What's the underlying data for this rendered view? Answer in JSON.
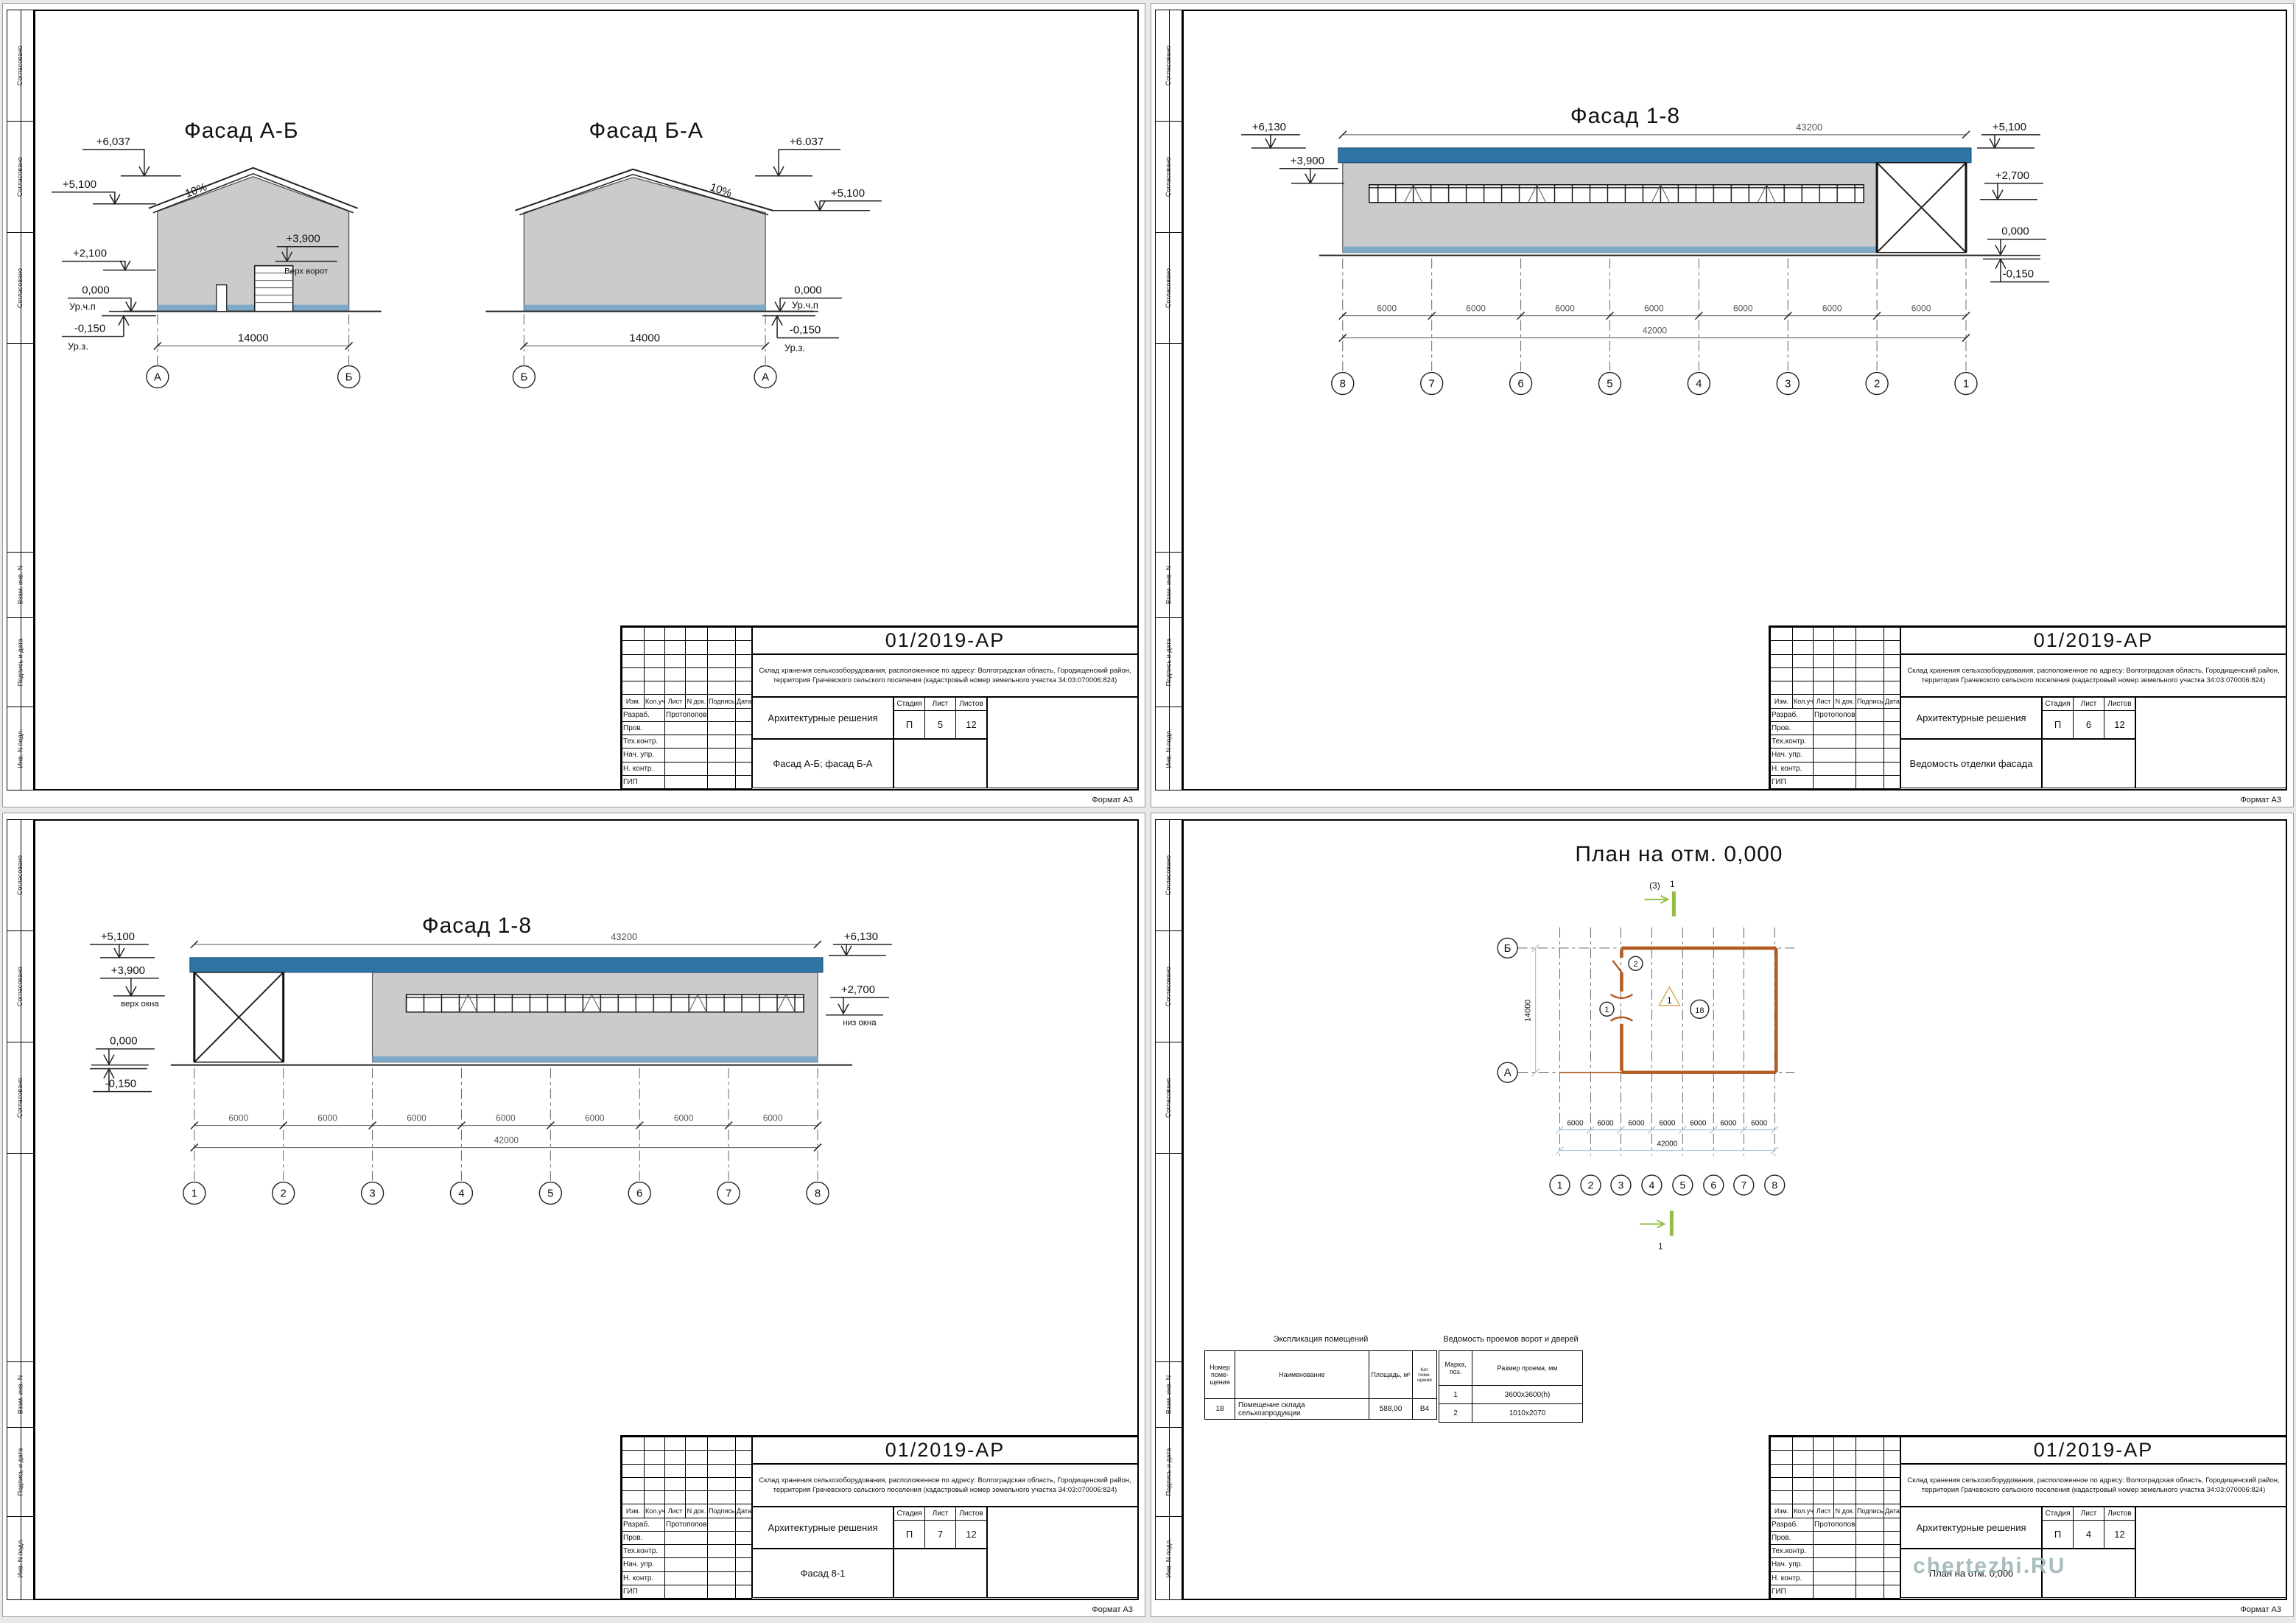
{
  "colors": {
    "roof_blue": "#2e74a5",
    "plinth_blue": "#7fa9c9",
    "wall_gray": "#cbcbcb",
    "plan_wall": "#b25a20",
    "section_green": "#93bd44",
    "section_text": "#b9cd7e",
    "plan_title": "#dcc690",
    "dim_blue": "#a9c6de",
    "tri_cream": "#d2ac62",
    "watermark": "#9fb6b6"
  },
  "side": [
    "Согласовано",
    "Взам. инв. N",
    "Подпись и дата",
    "Инв. N подл."
  ],
  "tb": {
    "code": "01/2019-АР",
    "desc": "Склад хранения сельхозоборудования, расположенное по адресу: Волгоградская область, Городищенский район, территория Грачевского сельского поселения (кадастровый номер земельного участка 34:03:070006:824)",
    "disc": "Архитектурные решения",
    "stage_h": "Стадия",
    "list_h": "Лист",
    "listov_h": "Листов",
    "stage": "П",
    "listov": "12",
    "c_izm": "Изм.",
    "c_kol": "Кол.уч",
    "c_list": "Лист",
    "c_ndok": "N док.",
    "c_podp": "Подпись",
    "c_data": "Дата",
    "r_razrab": "Разраб.",
    "r_prov": "Пров.",
    "r_tehk": "Тех.контр.",
    "r_nach": "Нач. упр.",
    "r_nkontr": "Н. контр.",
    "r_gip": "ГИП",
    "developer": "Протопопов",
    "format": "Формат А3"
  },
  "sheets": {
    "s1": {
      "sheet_no": "5",
      "doc_name": "Фасад А-Б; фасад Б-А",
      "f1": {
        "title": "Фасад А-Б",
        "m6037": "+6,037",
        "m5100": "+5,100",
        "m2100": "+2,100",
        "m0": "0,000",
        "floor": "Ур.ч.п",
        "m015": "-0,150",
        "ground": "Ур.з.",
        "slope": "10%",
        "m3900": "+3,900",
        "gate_label": "Верх ворот",
        "dim": "14000",
        "ax_l": "А",
        "ax_r": "Б"
      },
      "f2": {
        "title": "Фасад Б-А",
        "m6037": "+6.037",
        "m5100": "+5,100",
        "m0": "0,000",
        "floor": "Ур.ч.п",
        "m015": "-0,150",
        "ground": "Ур.з.",
        "slope": "10%",
        "dim": "14000",
        "ax_l": "Б",
        "ax_r": "А"
      }
    },
    "s2": {
      "sheet_no": "6",
      "doc_name": "Ведомость отделки фасада",
      "title": "Фасад 1-8",
      "m6130": "+6,130",
      "m3900": "+3,900",
      "m5100": "+5,100",
      "m2700": "+2,700",
      "m0": "0,000",
      "m015": "-0,150",
      "dim_top": "43200",
      "dim_bay": "6000",
      "dim_total": "42000",
      "axes": [
        "8",
        "7",
        "6",
        "5",
        "4",
        "3",
        "2",
        "1"
      ]
    },
    "s3": {
      "sheet_no": "7",
      "doc_name": "Фасад 8-1",
      "title": "Фасад 1-8",
      "m5100": "+5,100",
      "m3900": "+3,900",
      "top_win": "верх окна",
      "m0": "0,000",
      "m015": "-0,150",
      "m6130": "+6,130",
      "m2700": "+2,700",
      "bot_win": "низ окна",
      "dim_top": "43200",
      "dim_bay": "6000",
      "dim_total": "42000",
      "axes": [
        "1",
        "2",
        "3",
        "4",
        "5",
        "6",
        "7",
        "8"
      ]
    },
    "s4": {
      "sheet_no": "4",
      "doc_name": "План на отм. 0,000",
      "title": "План на отм. 0,000",
      "section_ref": "(3)",
      "section_no": "1",
      "dim_v": "14000",
      "dim_bay": "6000",
      "dim_total": "42000",
      "axes": [
        "1",
        "2",
        "3",
        "4",
        "5",
        "6",
        "7",
        "8"
      ],
      "ax_a": "А",
      "ax_b": "Б",
      "door1": "1",
      "door2": "2",
      "room_tri": "1",
      "room_no": "18",
      "table1": {
        "title": "Экспликация помещений",
        "h": [
          "Номер поме-щения",
          "Наименование",
          "Площадь, м²",
          "Кат. поме-щения"
        ],
        "r": [
          "18",
          "Помещение склада сельхозпродукции",
          "588,00",
          "В4"
        ]
      },
      "table2": {
        "title": "Ведомость проемов ворот и дверей",
        "h": [
          "Марка, поз.",
          "Размер проема, мм"
        ],
        "r1": [
          "1",
          "3600x3600(h)"
        ],
        "r2": [
          "2",
          "1010x2070"
        ]
      },
      "watermark": "chertezhi.RU"
    }
  }
}
